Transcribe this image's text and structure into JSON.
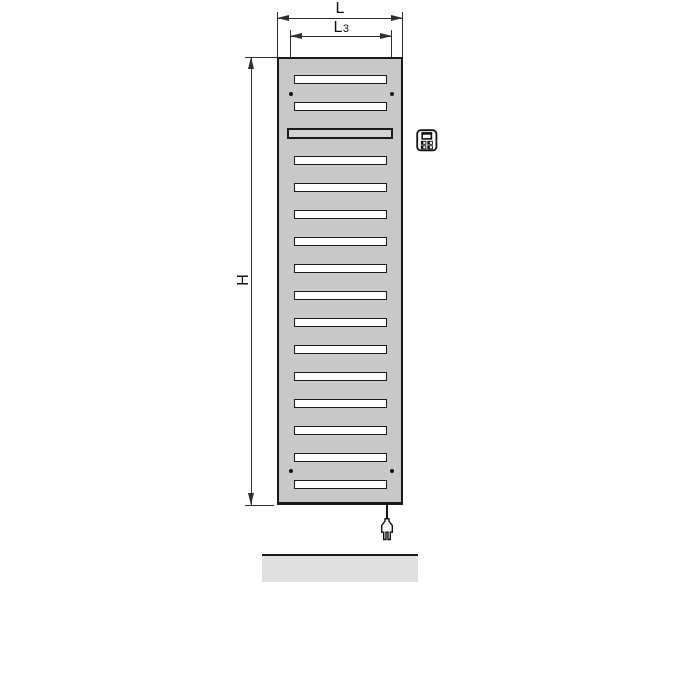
{
  "diagram": {
    "kind": "electric-radiator-dimension-drawing",
    "dims": {
      "overall_width": {
        "label": "L"
      },
      "mounting_width": {
        "label": "L",
        "sub": "3"
      },
      "overall_height": {
        "label": "H"
      }
    },
    "radiator": {
      "slot_count": 16,
      "element_slot_number": 3,
      "mounting_dot_count": 4
    },
    "icons": {
      "controller": "controller-icon",
      "plug": "power-plug-icon"
    },
    "colors": {
      "body": "#c8c8c8",
      "slot": "#ffffff",
      "element": "#d3d3d3",
      "outline": "#1a1a1a",
      "dim": "#2f2f2f",
      "floor": "#e0e0e0"
    }
  }
}
